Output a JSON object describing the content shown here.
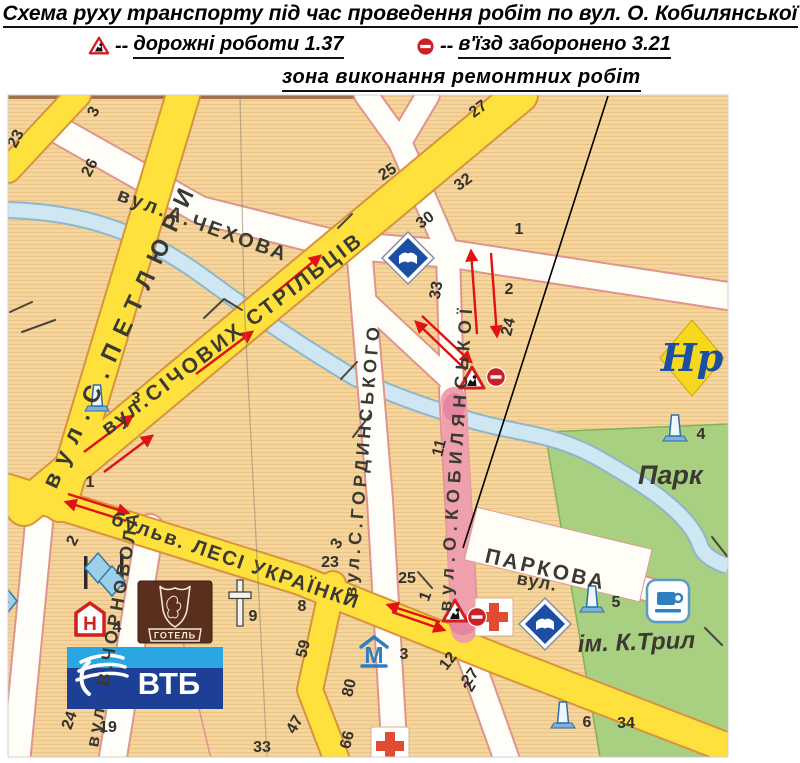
{
  "header": {
    "title": "Схема руху транспорту під час проведення робіт по вул. О. Кобилянської",
    "legend": [
      {
        "icon": "roadworks-sign",
        "dashes": "--",
        "label": "дорожні роботи 1.37"
      },
      {
        "icon": "no-entry-sign",
        "dashes": "--",
        "label": "в'їзд заборонено 3.21"
      }
    ],
    "zone_label": "зона виконання ремонтних робіт"
  },
  "colors": {
    "map_bg": "#f4d59e",
    "road_yellow": "#ffe13d",
    "yellow_casing": "#d8933e",
    "road_white": "#fffdf7",
    "white_casing": "#df958d",
    "water": "#cfe7f2",
    "water_casing": "#8fb6ca",
    "park": "#a9cf80",
    "repair_zone": "#ee9daa",
    "arrow": "#e01212",
    "sign_red": "#cc2026",
    "green_text": "#2e7d1f"
  },
  "map": {
    "street_labels": [
      {
        "text": "вул.А.ЧЕХОВА",
        "x": 116,
        "y": 200,
        "rot": 20,
        "size": 20,
        "ls": 3
      },
      {
        "text": "вул.С.ПЕТЛЮРИ",
        "x": 56,
        "y": 490,
        "rot": -65,
        "size": 24,
        "ls": 11
      },
      {
        "text": "вул.СІЧОВИХ СТРІЛЬЦІВ",
        "x": 108,
        "y": 436,
        "rot": -37,
        "size": 21,
        "ls": 3
      },
      {
        "text": "вул.О.КОБИЛЯНСЬКОЇ",
        "x": 451,
        "y": 612,
        "rot": -86,
        "size": 18,
        "ls": 6,
        "color": "#59564f"
      },
      {
        "text": "вул.С.ГОРДИНСЬКОГО",
        "x": 356,
        "y": 598,
        "rot": -85,
        "size": 18,
        "ls": 4
      },
      {
        "text": "вул. В.ЧОРНОВОЛА",
        "x": 98,
        "y": 748,
        "rot": -80,
        "size": 18,
        "ls": 4
      },
      {
        "text": "бульв. ЛЕСІ УКРАЇНКИ",
        "x": 110,
        "y": 524,
        "rot": 19,
        "size": 20,
        "ls": 2
      },
      {
        "text": "ПАРКОВА",
        "x": 484,
        "y": 562,
        "rot": 13,
        "size": 21,
        "ls": 3
      },
      {
        "text": "вул.",
        "x": 516,
        "y": 584,
        "rot": 10,
        "size": 18,
        "ls": 1
      },
      {
        "text": "Парк",
        "x": 638,
        "y": 484,
        "rot": 0,
        "size": 27,
        "italic": 1,
        "color": "#2e7d1f"
      },
      {
        "text": "ім. К.Трил",
        "x": 578,
        "y": 652,
        "rot": -2,
        "size": 24,
        "italic": 1,
        "color": "#2e7d1f"
      }
    ],
    "house_numbers": [
      {
        "t": "23",
        "x": 20,
        "y": 141,
        "r": -62
      },
      {
        "t": "3",
        "x": 98,
        "y": 114,
        "r": -62
      },
      {
        "t": "26",
        "x": 94,
        "y": 170,
        "r": -62
      },
      {
        "t": "25",
        "x": 390,
        "y": 176,
        "r": -32
      },
      {
        "t": "27",
        "x": 481,
        "y": 113,
        "r": -36
      },
      {
        "t": "30",
        "x": 428,
        "y": 224,
        "r": -36
      },
      {
        "t": "32",
        "x": 466,
        "y": 186,
        "r": -36
      },
      {
        "t": "33",
        "x": 441,
        "y": 291,
        "r": -80
      },
      {
        "t": "1",
        "x": 519,
        "y": 234,
        "r": 0
      },
      {
        "t": "2",
        "x": 509,
        "y": 294,
        "r": 0
      },
      {
        "t": "24",
        "x": 513,
        "y": 328,
        "r": -76
      },
      {
        "t": "11",
        "x": 444,
        "y": 449,
        "r": -76
      },
      {
        "t": "1",
        "x": 430,
        "y": 598,
        "r": -70
      },
      {
        "t": "3",
        "x": 341,
        "y": 546,
        "r": -60
      },
      {
        "t": "23",
        "x": 330,
        "y": 567,
        "r": 0
      },
      {
        "t": "25",
        "x": 407,
        "y": 583,
        "r": 0
      },
      {
        "t": "1",
        "x": 90,
        "y": 487,
        "r": 0
      },
      {
        "t": "2",
        "x": 77,
        "y": 543,
        "r": -62
      },
      {
        "t": "8",
        "x": 302,
        "y": 611,
        "r": 0
      },
      {
        "t": "9",
        "x": 253,
        "y": 621,
        "r": 0
      },
      {
        "t": "59",
        "x": 308,
        "y": 650,
        "r": -76
      },
      {
        "t": "80",
        "x": 354,
        "y": 689,
        "r": -76
      },
      {
        "t": "47",
        "x": 299,
        "y": 727,
        "r": -60
      },
      {
        "t": "24",
        "x": 74,
        "y": 722,
        "r": -70
      },
      {
        "t": "19",
        "x": 108,
        "y": 732,
        "r": 0
      },
      {
        "t": "33",
        "x": 262,
        "y": 752,
        "r": 0
      },
      {
        "t": "66",
        "x": 352,
        "y": 741,
        "r": -76
      },
      {
        "t": "2",
        "x": 474,
        "y": 689,
        "r": -60
      },
      {
        "t": "12",
        "x": 452,
        "y": 664,
        "r": -52
      },
      {
        "t": "27",
        "x": 474,
        "y": 680,
        "r": -52
      },
      {
        "t": "34",
        "x": 626,
        "y": 728,
        "r": 0
      },
      {
        "t": "4",
        "x": 701,
        "y": 439,
        "r": 0
      },
      {
        "t": "5",
        "x": 616,
        "y": 607,
        "r": 0
      },
      {
        "t": "6",
        "x": 587,
        "y": 727,
        "r": 0
      },
      {
        "t": "3",
        "x": 136,
        "y": 403,
        "r": 0
      },
      {
        "t": "4",
        "x": 117,
        "y": 632,
        "r": 0
      },
      {
        "t": "3",
        "x": 404,
        "y": 659,
        "r": 0
      },
      {
        "t": "2",
        "x": 5,
        "y": 603,
        "r": 0,
        "c": "#cc2026"
      }
    ],
    "arrows": [
      {
        "x1": 84,
        "y1": 452,
        "x2": 132,
        "y2": 416
      },
      {
        "x1": 104,
        "y1": 472,
        "x2": 152,
        "y2": 436
      },
      {
        "x1": 196,
        "y1": 374,
        "x2": 252,
        "y2": 332
      },
      {
        "x1": 274,
        "y1": 294,
        "x2": 320,
        "y2": 256
      },
      {
        "x1": 477,
        "y1": 334,
        "x2": 471,
        "y2": 251
      },
      {
        "x1": 491,
        "y1": 253,
        "x2": 497,
        "y2": 336
      },
      {
        "x1": 466,
        "y1": 370,
        "x2": 416,
        "y2": 322
      },
      {
        "x1": 422,
        "y1": 316,
        "x2": 471,
        "y2": 362
      },
      {
        "x1": 126,
        "y1": 521,
        "x2": 66,
        "y2": 502
      },
      {
        "x1": 68,
        "y1": 494,
        "x2": 128,
        "y2": 513
      },
      {
        "x1": 440,
        "y1": 622,
        "x2": 388,
        "y2": 605
      },
      {
        "x1": 392,
        "y1": 612,
        "x2": 444,
        "y2": 630
      }
    ],
    "poi": [
      {
        "icon": "monument",
        "x": 97,
        "y": 400
      },
      {
        "icon": "monument",
        "x": 675,
        "y": 430
      },
      {
        "icon": "monument",
        "x": 592,
        "y": 601
      },
      {
        "icon": "monument",
        "x": 563,
        "y": 717
      },
      {
        "icon": "book-sign",
        "x": 408,
        "y": 258
      },
      {
        "icon": "book-sign",
        "x": 545,
        "y": 624
      },
      {
        "icon": "red-cross",
        "x": 494,
        "y": 617
      },
      {
        "icon": "red-cross",
        "x": 390,
        "y": 746
      },
      {
        "icon": "cafe",
        "x": 668,
        "y": 601
      },
      {
        "icon": "museum-m",
        "x": 374,
        "y": 652,
        "text": "М"
      },
      {
        "icon": "hotel-h",
        "x": 90,
        "y": 622,
        "text": "Н"
      },
      {
        "icon": "hotel-logo",
        "x": 175,
        "y": 612,
        "text": "ГОТЕЛЬ"
      },
      {
        "icon": "vtb-logo",
        "x": 145,
        "y": 678,
        "text": "ВТБ"
      },
      {
        "icon": "church-cross",
        "x": 240,
        "y": 603
      },
      {
        "icon": "gothic-landmark",
        "x": 692,
        "y": 358,
        "text": "Нр"
      },
      {
        "icon": "hotel-diamonds",
        "x": 103,
        "y": 573
      },
      {
        "icon": "diamond-partial",
        "x": 5,
        "y": 601
      },
      {
        "icon": "roadworks-sign",
        "x": 472,
        "y": 379
      },
      {
        "icon": "no-entry-sign",
        "x": 496,
        "y": 377
      },
      {
        "icon": "roadworks-sign",
        "x": 455,
        "y": 612
      },
      {
        "icon": "no-entry-sign",
        "x": 477,
        "y": 617
      }
    ],
    "pointer_line": {
      "x1": 608,
      "y1": 96,
      "x2": 463,
      "y2": 548
    }
  }
}
